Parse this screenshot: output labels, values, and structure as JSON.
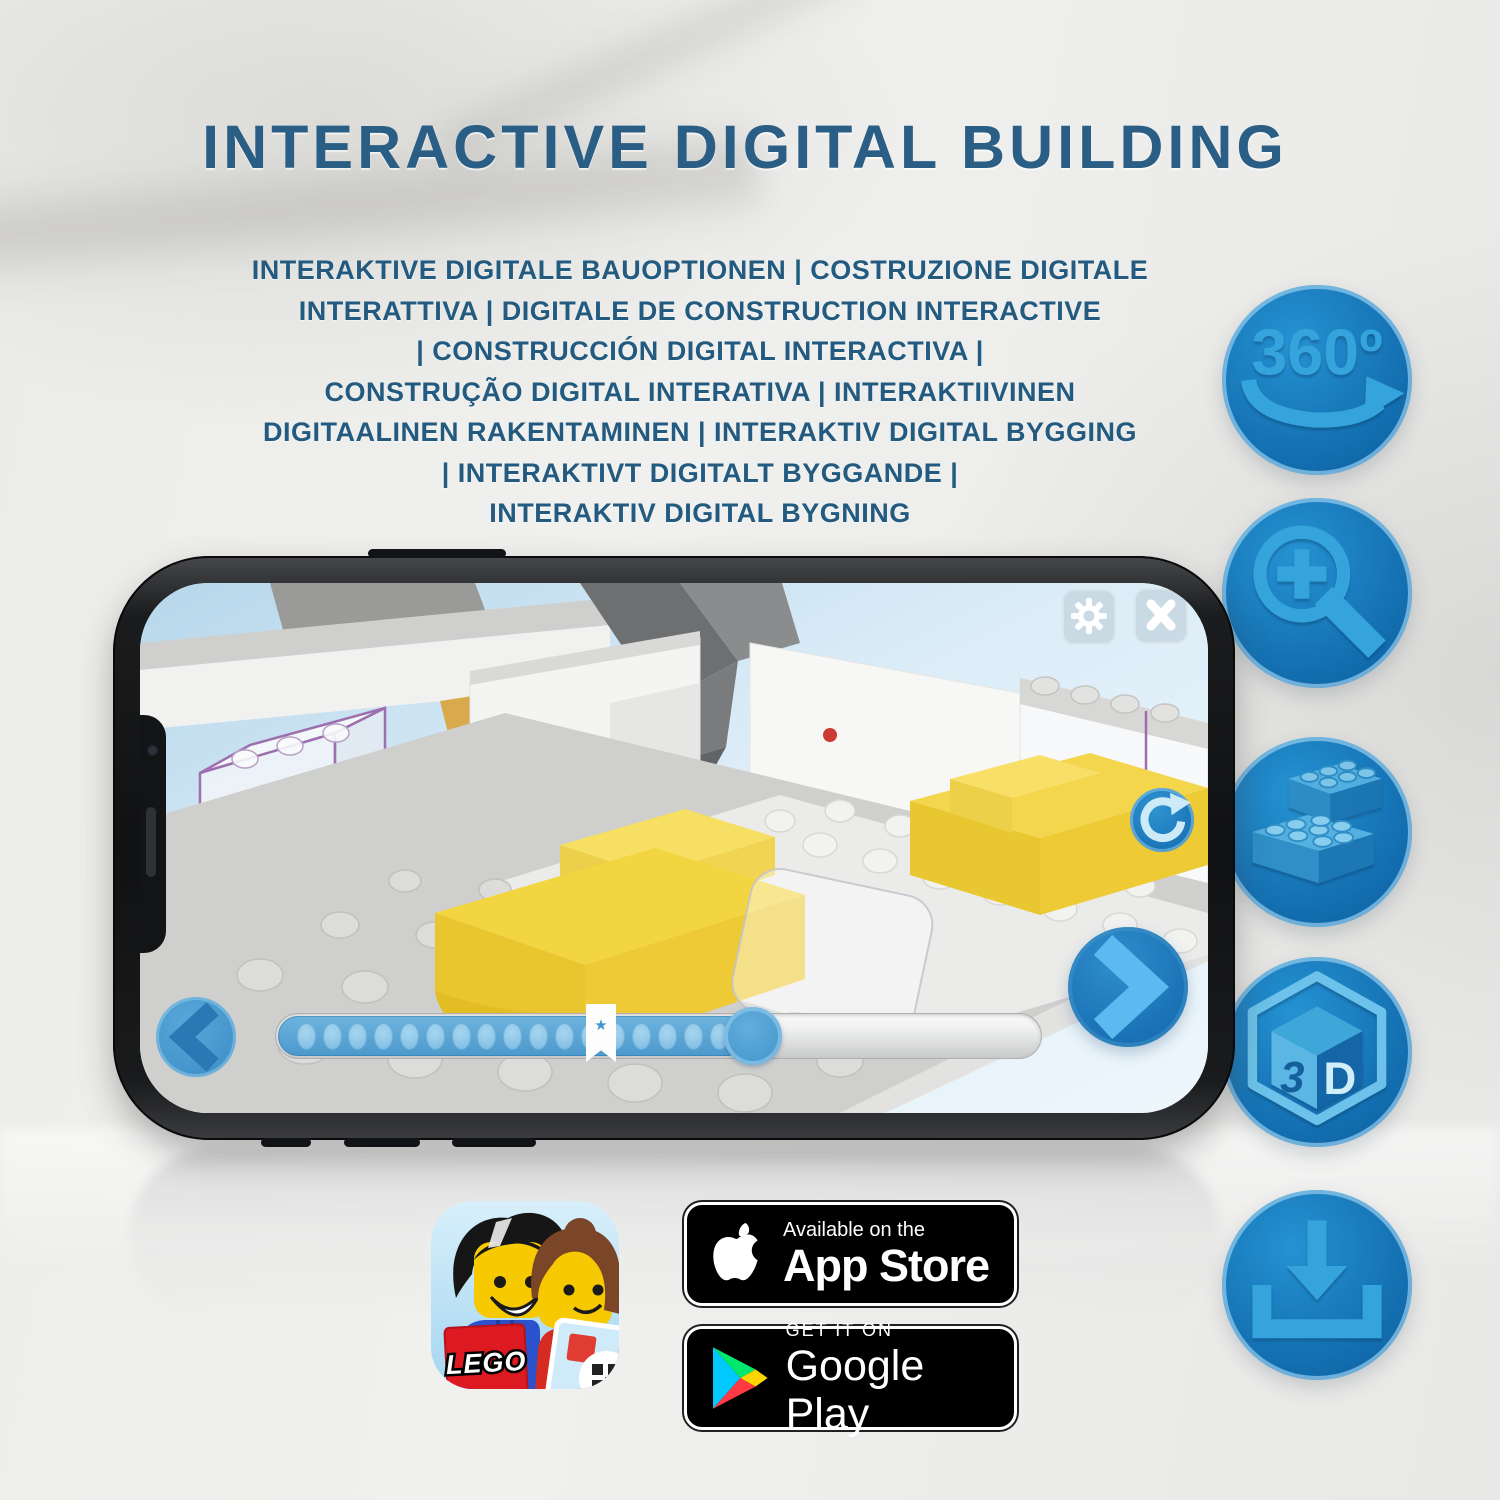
{
  "header": {
    "title": "INTERACTIVE DIGITAL BUILDING",
    "subtitle_lines": [
      "INTERAKTIVE DIGITALE BAUOPTIONEN | COSTRUZIONE DIGITALE",
      "INTERATTIVA | DIGITALE DE CONSTRUCTION INTERACTIVE",
      "| CONSTRUCCIÓN DIGITAL INTERACTIVA |",
      "CONSTRUÇÃO DIGITAL INTERATIVA | INTERAKTIIVINEN",
      "DIGITAALINEN RAKENTAMINEN | INTERAKTIV DIGITAL BYGGING",
      "| INTERAKTIVT DIGITALT BYGGANDE |",
      "INTERAKTIV DIGITAL BYGNING"
    ]
  },
  "feature_icons": {
    "rotate_360": {
      "label": "360º"
    },
    "cube_3d": {
      "left_letter": "3",
      "right_letter": "D"
    }
  },
  "phone_app": {
    "progress": {
      "percent": 62,
      "bookmark_percent": 42.5,
      "dot_count": 17,
      "bookmark_star": "★"
    }
  },
  "store_badges": {
    "app_store": {
      "tagline": "Available on the",
      "name": "App Store"
    },
    "google_play": {
      "tagline": "GET IT ON",
      "name": "Google Play"
    }
  },
  "lego_app_icon": {
    "wordmark": "LEGO"
  },
  "colors": {
    "title_blue": "#2b5e85",
    "feature_circle_blue": "#1373b5",
    "glyph_blue": "#36a3dc",
    "bed_yellow": "#f3d441",
    "progress_blue": "#58a5d6"
  }
}
